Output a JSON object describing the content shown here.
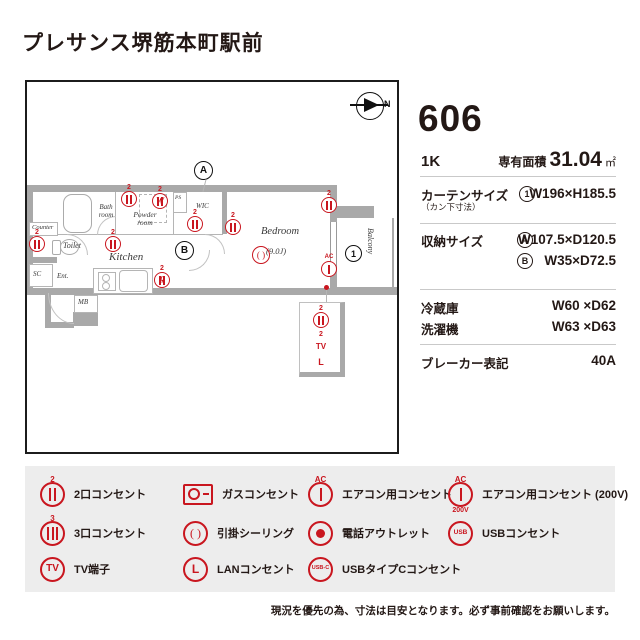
{
  "title": "プレサンス堺筋本町駅前",
  "plan": {
    "compass_n": "N",
    "marks": {
      "a": "A",
      "b": "B",
      "one": "1"
    },
    "rooms": {
      "bath1": "Bath",
      "bath2": "room",
      "powder1": "Powder",
      "powder2": "room",
      "ps": "PS",
      "wic": "WIC",
      "bedroom": "Bedroom",
      "bedroom_size": "(9.0J)",
      "kitchen": "Kitchen",
      "counter": "Counter",
      "toilet": "Toilet",
      "sc": "SC",
      "ent": "Ent.",
      "mb": "MB",
      "balcony": "Balcony"
    },
    "outlets": {
      "o1": {
        "num": "2"
      },
      "o2": {
        "num": "2",
        "letter": "W"
      },
      "o3": {
        "num": "2"
      },
      "o4": {
        "num": "2"
      },
      "o5": {
        "num": "2"
      },
      "o6": {
        "num": "2"
      },
      "o7": {
        "num": "2"
      },
      "o8": {
        "num": "2",
        "letter": "R"
      },
      "ac": {
        "tag": "AC"
      },
      "ceiling": {
        "text": "( )"
      },
      "c_out": {
        "num": "2"
      },
      "c_tv": {
        "num": "2",
        "text": "TV"
      },
      "c_lan": {
        "text": "L"
      }
    }
  },
  "panel": {
    "unit_no": "606",
    "layout": "1K",
    "area_label": "専有面積",
    "area_value": "31.04",
    "area_unit": "㎡",
    "curtain_label": "カーテンサイズ",
    "curtain_sub": "（カン下寸法）",
    "curtain_mark": "1",
    "curtain_value": "W196×H185.5",
    "storage_label": "収納サイズ",
    "storage_a_mark": "A",
    "storage_a_value": "W107.5×D120.5",
    "storage_b_mark": "B",
    "storage_b_value": "W35×D72.5",
    "fridge_label": "冷蔵庫",
    "fridge_value": "W60 ×D62",
    "washer_label": "洗濯機",
    "washer_value": "W63 ×D63",
    "breaker_label": "ブレーカー表記",
    "breaker_value": "40A"
  },
  "legend": {
    "items": [
      {
        "label": "2口コンセント",
        "tag": "2"
      },
      {
        "label": "ガスコンセント"
      },
      {
        "label": "エアコン用コンセント",
        "tag": "AC"
      },
      {
        "label": "エアコン用コンセント (200V)",
        "tag": "AC",
        "sub": "200V"
      },
      {
        "label": "3口コンセント",
        "tag": "3"
      },
      {
        "label": "引掛シーリング",
        "text": "( )"
      },
      {
        "label": "電話アウトレット"
      },
      {
        "label": "USBコンセント",
        "text": "USB"
      },
      {
        "label": "TV端子",
        "text": "TV"
      },
      {
        "label": "LANコンセント",
        "text": "L"
      },
      {
        "label": "USBタイプCコンセント",
        "text": "USB-C"
      }
    ]
  },
  "note": "現況を優先の為、寸法は目安となります。必ず事前確認をお願いします。",
  "colors": {
    "accent_red": "#c9161f",
    "wall_gray": "#a9a9a9",
    "text_dark": "#231815"
  }
}
